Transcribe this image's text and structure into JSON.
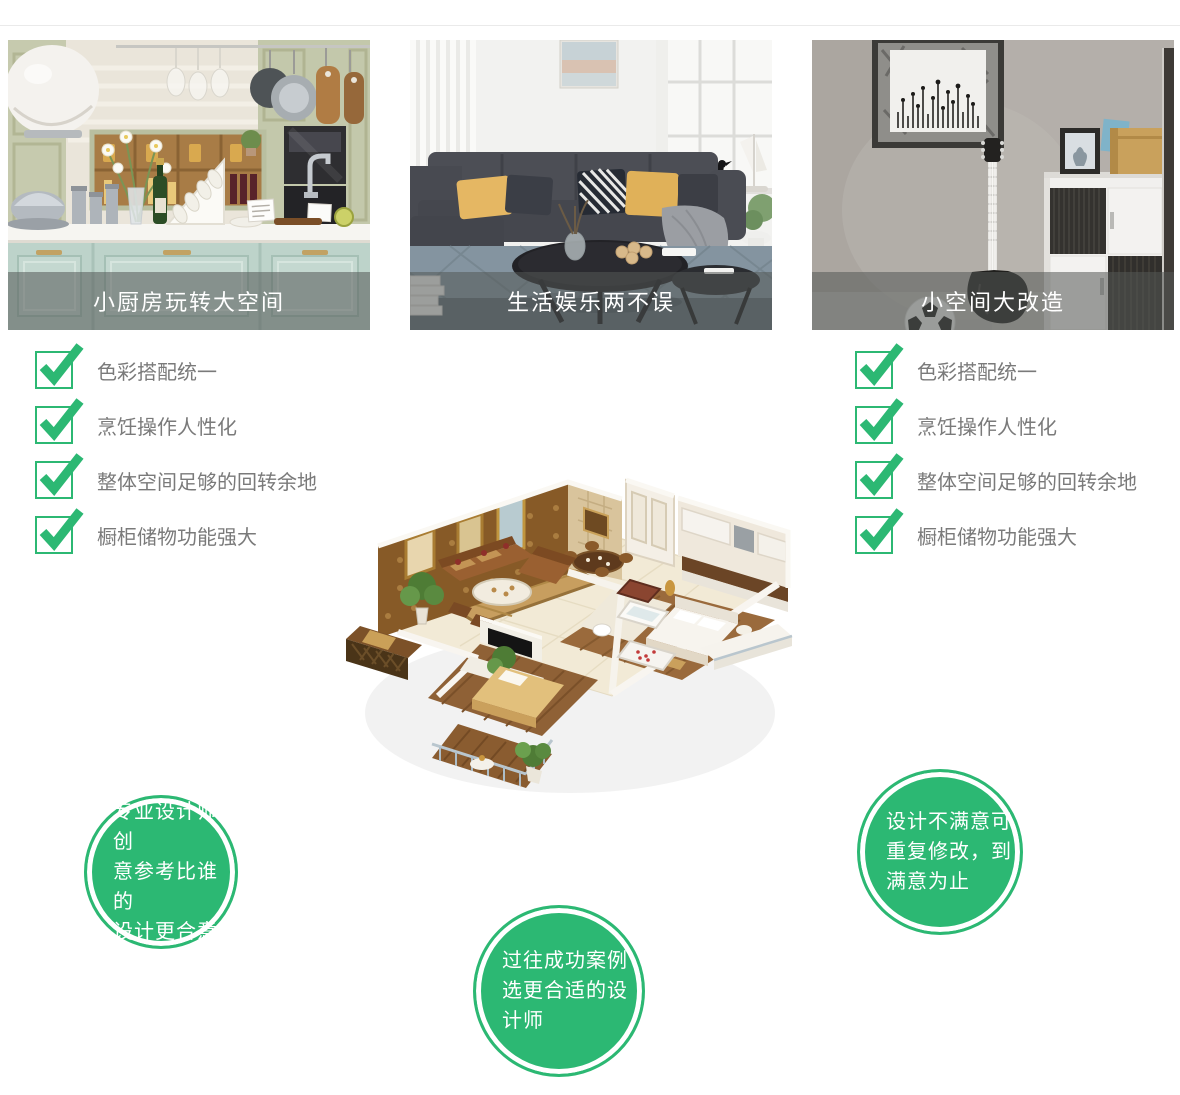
{
  "colors": {
    "accent_green": "#2cb873",
    "checklist_text": "#7a7a7a",
    "caption_text": "#ffffff",
    "caption_bar": "rgba(84,88,86,0.55)",
    "divider": "#eaeaea"
  },
  "cards": [
    {
      "caption": "小厨房玩转大空间"
    },
    {
      "caption": "生活娱乐两不误"
    },
    {
      "caption": "小空间大改造"
    }
  ],
  "checklists": {
    "left": {
      "items": [
        "色彩搭配统一",
        "烹饪操作人性化",
        "整体空间足够的回转余地",
        "橱柜储物功能强大"
      ]
    },
    "right": {
      "items": [
        "色彩搭配统一",
        "烹饪操作人性化",
        "整体空间足够的回转余地",
        "橱柜储物功能强大"
      ]
    }
  },
  "badges": [
    {
      "lines": [
        "专业设计师创",
        "意参考比谁的",
        "设计更合意"
      ]
    },
    {
      "lines": [
        "过往成功案例",
        "选更合适的设",
        "计师"
      ]
    },
    {
      "lines": [
        "设计不满意可",
        "重复修改，到",
        "满意为止"
      ]
    }
  ]
}
